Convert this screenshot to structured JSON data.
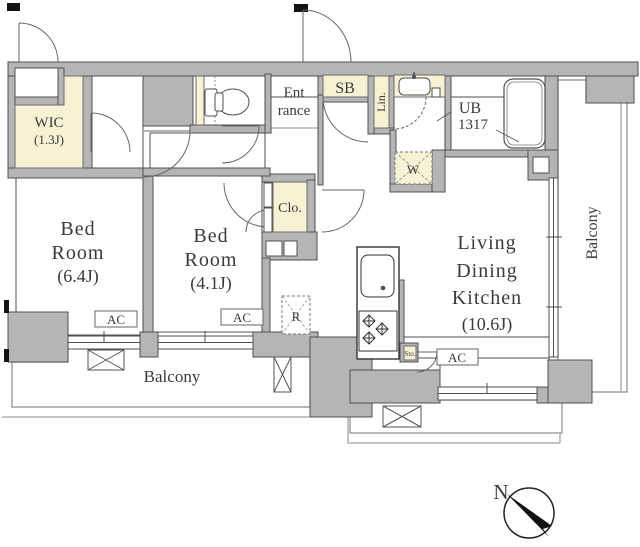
{
  "colors": {
    "wall": "#b5b5b5",
    "wall_line": "#4f4f4f",
    "cream": "#f7f2d4",
    "thin_line": "#8a8a8a",
    "text": "#3a3a3a",
    "black": "#141414"
  },
  "rooms": {
    "wic": {
      "name": "WIC",
      "size": "(1.3J)"
    },
    "bedroom1": {
      "name1": "Bed",
      "name2": "Room",
      "size": "(6.4J)"
    },
    "bedroom2": {
      "name1": "Bed",
      "name2": "Room",
      "size": "(4.1J)"
    },
    "ldk": {
      "name1": "Living",
      "name2": "Dining",
      "name3": "Kitchen",
      "size": "(10.6J)"
    },
    "entrance": {
      "name1": "Ent",
      "name2": "rance"
    },
    "unit_bath": {
      "name": "UB",
      "size": "1317"
    },
    "shoe_box": "SB",
    "linen": "Lin.",
    "closet": "Clo.",
    "storage": "Sto.",
    "balcony_bottom": "Balcony",
    "balcony_right": "Balcony"
  },
  "fixtures": {
    "washing_machine": "W",
    "refrigerator": "R",
    "ac_bedroom1": "AC",
    "ac_bedroom2": "AC",
    "ac_ldk": "AC"
  },
  "compass": {
    "north": "N"
  }
}
